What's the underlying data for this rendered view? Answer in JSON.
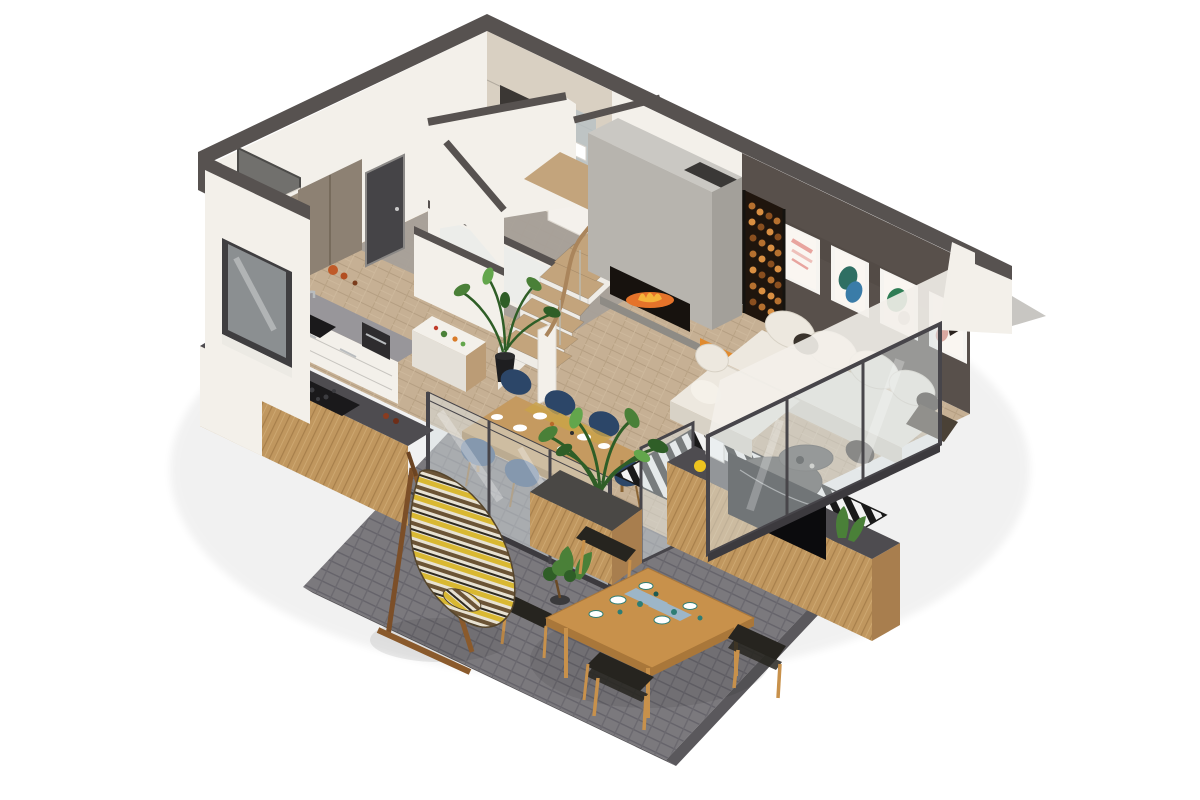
{
  "title": "3D isometric floor plan render",
  "background": "#ffffff",
  "colors": {
    "bg": "#ffffff",
    "wallTop": "#575250",
    "wallWhite": "#f3f0ea",
    "wallShade": "#e4e0d8",
    "tileBeige": "#d9d0c2",
    "tileDark": "#3b3734",
    "artWall": "#58504b",
    "floorWood": "#c6b094",
    "floorGray": "#a7a099",
    "terracePaver": "#7b797d",
    "terraceJoint": "#65636a",
    "terraceEdge": "#5a585c",
    "glass": "#d8dfe1",
    "glassFrame": "#47454a",
    "doorDark": "#454447",
    "woodCabinet": "#8d8173",
    "woodLight": "#c9a25f",
    "woodMid": "#c0975f",
    "woodDark": "#a87e4e",
    "woodFrame": "#8a6434",
    "counterGray": "#98969a",
    "counterDark": "#4e4c50",
    "sinkBlack": "#1a191b",
    "stairTread": "#c3a47c",
    "stairRiser": "#efece6",
    "rail": "#aa855c",
    "concrete": "#b7b4ae",
    "concreteLight": "#cac8c3",
    "concreteSide": "#a3a09a",
    "fireboxDark": "#17120e",
    "fireOrange": "#e5732a",
    "fireYellow": "#f6b43a",
    "logBed": "#1f150d",
    "logWood": "#b5702f",
    "logWoodLight": "#d98f42",
    "logWoodDark": "#8a4f1f",
    "pouf": "#e08a2e",
    "poufSide": "#c06f1d",
    "sofaWhite": "#ede8df",
    "sofaShade": "#d8d2c6",
    "pillowDark": "#3a332c",
    "throwDark": "#4a4136",
    "rugBlack": "#191919",
    "rugWhite": "#f2f2f2",
    "tableOak": "#c59a60",
    "tableOakSide": "#9e7740",
    "chairNavy": "#2c4668",
    "chairNavyLight": "#33517a",
    "teakOutdoor": "#c8914b",
    "teakSide": "#a9773a",
    "seatBlack": "#26241f",
    "planterTop": "#4a4845",
    "plantGreen": "#4a8038",
    "plantGreenDark": "#2f5e27",
    "plantGreenLight": "#63a64c",
    "potBlack": "#1e1e20",
    "yellowAccent": "#edc41f",
    "napkinBlue": "#9db6c8",
    "tealDish": "#2e7d74",
    "hamYellow": "#d9b832",
    "hamBrown": "#6b5436",
    "hamCream": "#e8e2d2",
    "hamBlack": "#2e2a22",
    "metal": "#b9bcbe"
  },
  "scene": {
    "type": "isometric-3d-floor-plan-render",
    "rooms": [
      {
        "name": "kitchen",
        "features": [
          "black sink",
          "gray worktop",
          "white base cabinets",
          "coffee machine",
          "cutting block with vegetables",
          "potted plant",
          "bar counter with cooktop and blue kettle"
        ]
      },
      {
        "name": "entry-hall",
        "features": [
          "dark front door",
          "open coat closet with jackets",
          "shoes",
          "gray tile floor",
          "wood cabinet"
        ]
      },
      {
        "name": "bathroom",
        "features": [
          "wall-hung toilet",
          "dark tile panel",
          "washbasin on wood counter",
          "mirror",
          "glass partition"
        ]
      },
      {
        "name": "staircase",
        "features": [
          "winder stairs",
          "oak treads",
          "white risers",
          "wood handrail",
          "white parapet walls with dark caps"
        ]
      },
      {
        "name": "living-room",
        "features": [
          "concrete art wall with 4 abstract posters",
          "white L-shaped sectional sofa",
          "dark pillows",
          "black-white striped rug",
          "round two-tier coffee table",
          "orange pouf",
          "TV on low wood wall",
          "glass facade"
        ]
      },
      {
        "name": "fireplace",
        "features": [
          "concrete chimney block",
          "burning firebox",
          "vertical firewood store"
        ]
      },
      {
        "name": "dining-area",
        "features": [
          "oak dining table",
          "six navy chairs",
          "place settings",
          "glass sliding doors",
          "wood planter with palm plant"
        ]
      },
      {
        "name": "terrace",
        "features": [
          "gray pavers",
          "teak outdoor dining table",
          "four black-seat chairs",
          "tableware with teal dishes",
          "bonsai pot",
          "striped hammock chair on wood stand"
        ]
      }
    ],
    "floor_material": "herringbone oak",
    "wall_cut_color": "#575250",
    "view": "cutaway axonometric from south-west"
  }
}
